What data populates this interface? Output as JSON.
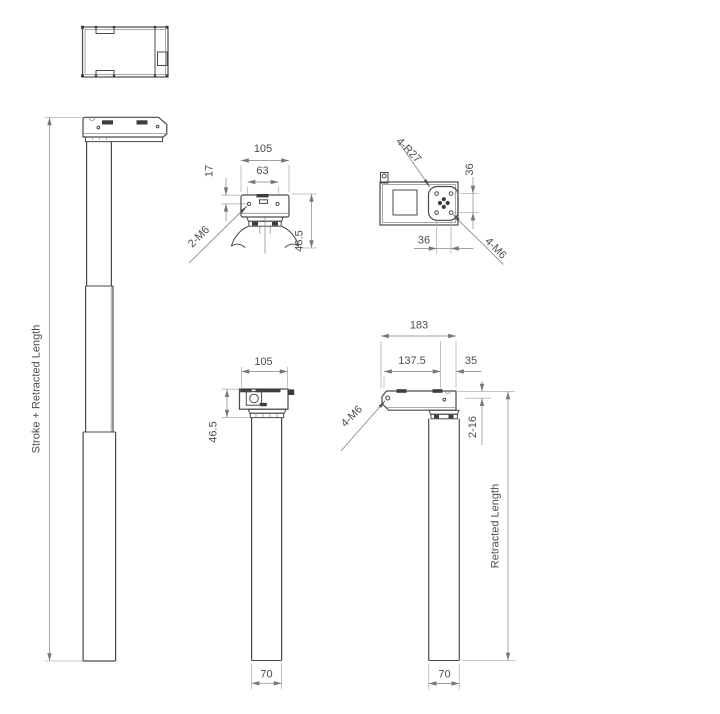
{
  "views": {
    "head_front": {
      "overall_width": "105",
      "slot_spacing": "63",
      "hole_offset": "17",
      "height": "46.5",
      "thread": "2-M6"
    },
    "head_bottom": {
      "radius": "4-R27",
      "hole_spacing_vertical": "36",
      "hole_spacing_horizontal": "36",
      "thread": "4-M6"
    },
    "retracted_front": {
      "width": "105",
      "head_height": "46.5",
      "tube_width": "70"
    },
    "retracted_side": {
      "overall_width": "183",
      "center_offset": "137.5",
      "edge_offset": "35",
      "thread": "4-M6",
      "slot_note": "2-16",
      "length_label": "Retracted Length",
      "tube_width": "70"
    },
    "extended_side": {
      "length_label": "Stroke + Retracted Length"
    }
  },
  "colors": {
    "outline": "#4a4a4a",
    "dimension": "#a0a0a0",
    "text": "#4d4d4d",
    "background": "#ffffff"
  }
}
